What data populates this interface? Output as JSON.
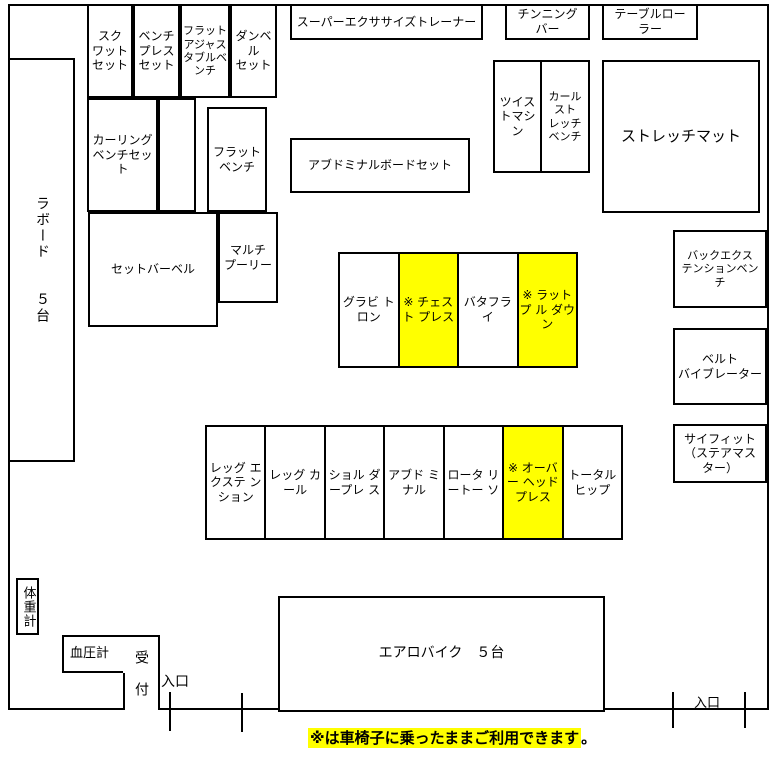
{
  "colors": {
    "highlight": "#ffff00",
    "line": "#000000",
    "background": "#ffffff"
  },
  "areas": {
    "laboard": "ラボード　　５台",
    "squat_set": "スク\nワット\nセット",
    "bench_press_set": "ベンチ\nプレス\nセット",
    "flat_adjustable_bench": "フラット\nアジャス\nタブルベ\nンチ",
    "dumbbell_set": "ダンベ\nル\nセット",
    "curling_bench_set": "カーリング\nベンチセッ\nト",
    "flat_bench": "フラット\nベンチ",
    "set_barbell": "セットバーベル",
    "multi_pulley": "マルチ\nプーリー",
    "super_exercise_trainer": "スーパーエクササイズトレーナー",
    "chinning_bar": "チンニング\nバー",
    "table_roller": "テーブルロー\nラー",
    "twist_machine": "ツイス\nトマシ\nン",
    "curl_stretch_bench": "カール\nスト\nレッチ\nベンチ",
    "stretch_mat": "ストレッチマット",
    "abdominal_board_set": "アブドミナルボードセット",
    "back_extension_bench": "バックエクス\nテンションベン\nチ",
    "belt_vibrator": "ベルト\nバイブレーター",
    "sci_fit": "サイフィット\n（ステアマス\nター）",
    "aero_bike": "エアロバイク　５台",
    "weight_scale": "体重計",
    "blood_pressure": "血圧計",
    "reception": "受　付",
    "entrance_left": "入口",
    "entrance_right": "入口"
  },
  "machine_row_1": [
    {
      "label": "グラビ\nトロン",
      "highlight": false
    },
    {
      "label": "※\nチェスト\nプレス",
      "highlight": true
    },
    {
      "label": "バタフラ\nイ",
      "highlight": false
    },
    {
      "label": "※\nラットプ\nル\nダウン",
      "highlight": true
    }
  ],
  "machine_row_2": [
    {
      "label": "レッグ\nエクステ\nンション",
      "highlight": false
    },
    {
      "label": "レッグ\nカール",
      "highlight": false
    },
    {
      "label": "ショル\nダープレ\nス",
      "highlight": false
    },
    {
      "label": "アブド\nミナル",
      "highlight": false
    },
    {
      "label": "ロータ\nリートー\nソ",
      "highlight": false
    },
    {
      "label": "※\nオーバー\nヘッド\nプレス",
      "highlight": true
    },
    {
      "label": "トータル\nヒップ",
      "highlight": false
    }
  ],
  "footnote": {
    "text": "※は車椅子に乗ったままご利用できます",
    "period": "。"
  }
}
